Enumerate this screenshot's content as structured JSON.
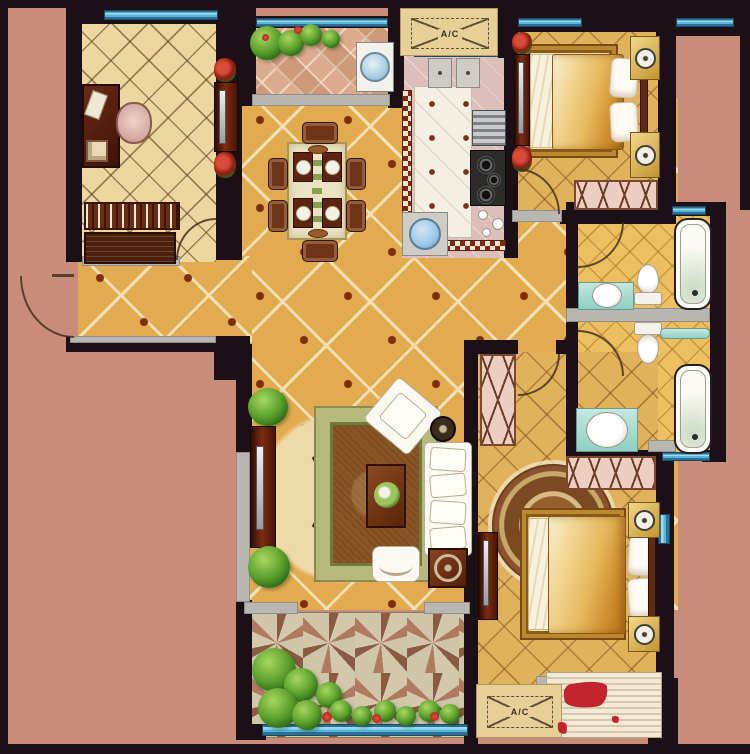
{
  "plan": {
    "type": "apartment-floor-plan",
    "ac_units": {
      "top": {
        "label": "A/C"
      },
      "bottom": {
        "label": "A/C"
      }
    },
    "palette": {
      "background_salmon": "#c98c7b",
      "wall_black": "#1b1016",
      "window_blue": "#57b7d8",
      "floor_main_tan": "#e3ab4f",
      "floor_study_cream": "#ecd7a0",
      "floor_kitchen_mauve": "#dcbfb9",
      "floor_bath_gold": "#ecbf60",
      "balcony_top_pink": "#dcaa8c",
      "balcony_bottom_sage": "#c8bd9f",
      "rug_green_border": "#b5ba7c",
      "wood_dark": "#5a2310",
      "bed_gold": "#e6b85c",
      "counter_teal": "#8fd0c2",
      "ac_platform_tan": "#e7d098",
      "watermark_red": "#c2232c"
    }
  }
}
